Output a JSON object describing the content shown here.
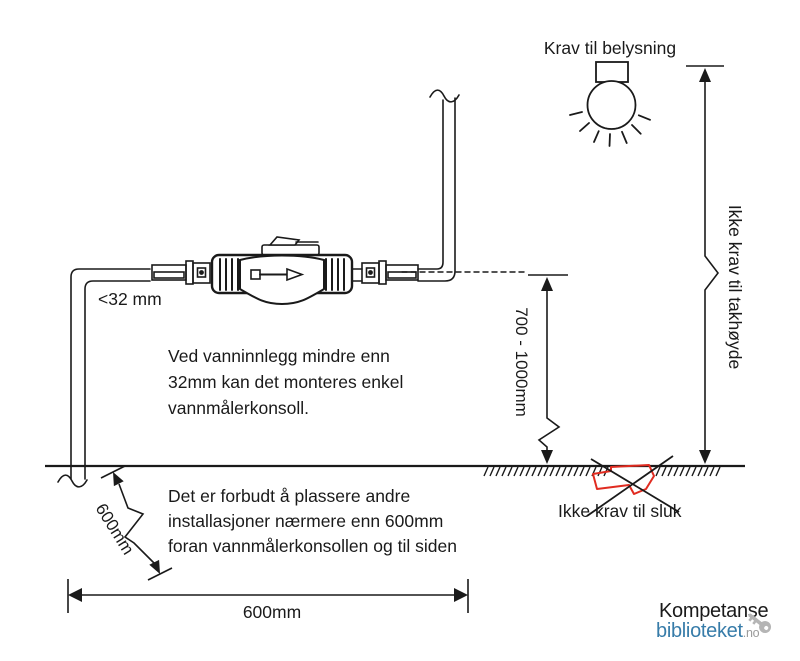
{
  "diagram": {
    "lighting_label": "Krav til belysning",
    "ceiling_label": "Ikke krav til takhøyde",
    "pipe_size_label": "<32 mm",
    "height_dimension": "700 - 1000mm",
    "drain_label": "Ikke krav til sluk",
    "diagonal_dimension": "600mm",
    "width_dimension": "600mm",
    "note_small_pipe": [
      "Ved vanninnlegg mindre enn",
      "32mm kan det monteres enkel",
      "vannmålerkonsoll."
    ],
    "note_forbidden": [
      "Det er forbudt å plassere andre",
      "installasjoner nærmere enn 600mm",
      "foran vannmålerkonsollen og til siden"
    ]
  },
  "logo": {
    "name": "Kompetanse",
    "library": "biblioteket",
    "tld": ".no"
  },
  "colors": {
    "ink": "#1a1a1a",
    "drain_red": "#e02b20",
    "logo_dark": "#4d4d4d",
    "logo_blue": "#377ca9",
    "logo_gray": "#9b9b9b",
    "logo_key": "#b5b5b5"
  }
}
